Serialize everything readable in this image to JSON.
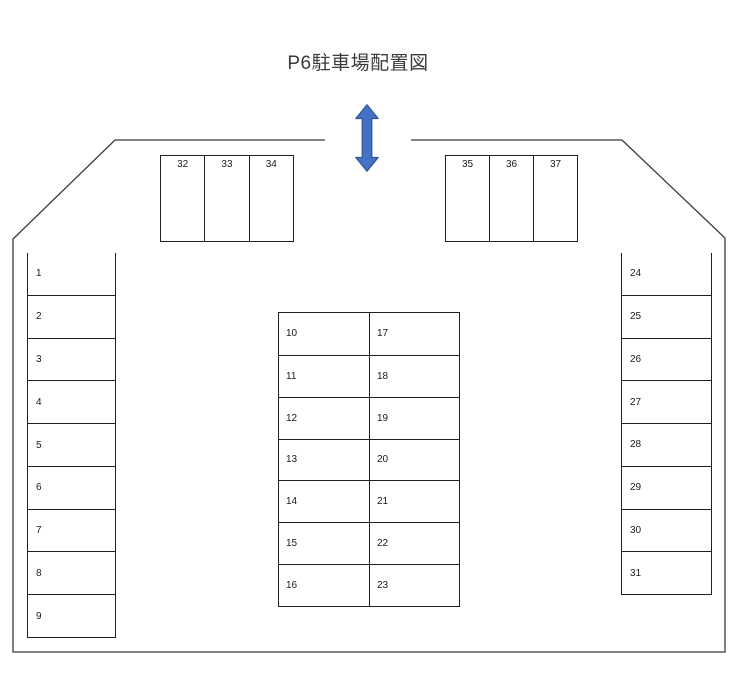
{
  "title": "P6駐車場配置図",
  "entrance_arrow": {
    "icon": "double-vertical-arrow",
    "fill": "#4472c4",
    "stroke": "#2e5597"
  },
  "colors": {
    "line": "#1f1f1f",
    "background": "#ffffff",
    "text": "#1a1a1a"
  },
  "lot": {
    "top_left_row": {
      "spaces": [
        "32",
        "33",
        "34"
      ]
    },
    "top_right_row": {
      "spaces": [
        "35",
        "36",
        "37"
      ]
    },
    "left_column": {
      "spaces": [
        "1",
        "2",
        "3",
        "4",
        "5",
        "6",
        "7",
        "8",
        "9"
      ]
    },
    "center_block": {
      "left_column": {
        "spaces": [
          "10",
          "11",
          "12",
          "13",
          "14",
          "15",
          "16"
        ]
      },
      "right_column": {
        "spaces": [
          "17",
          "18",
          "19",
          "20",
          "21",
          "22",
          "23"
        ]
      }
    },
    "right_column": {
      "spaces": [
        "24",
        "25",
        "26",
        "27",
        "28",
        "29",
        "30",
        "31"
      ]
    }
  }
}
